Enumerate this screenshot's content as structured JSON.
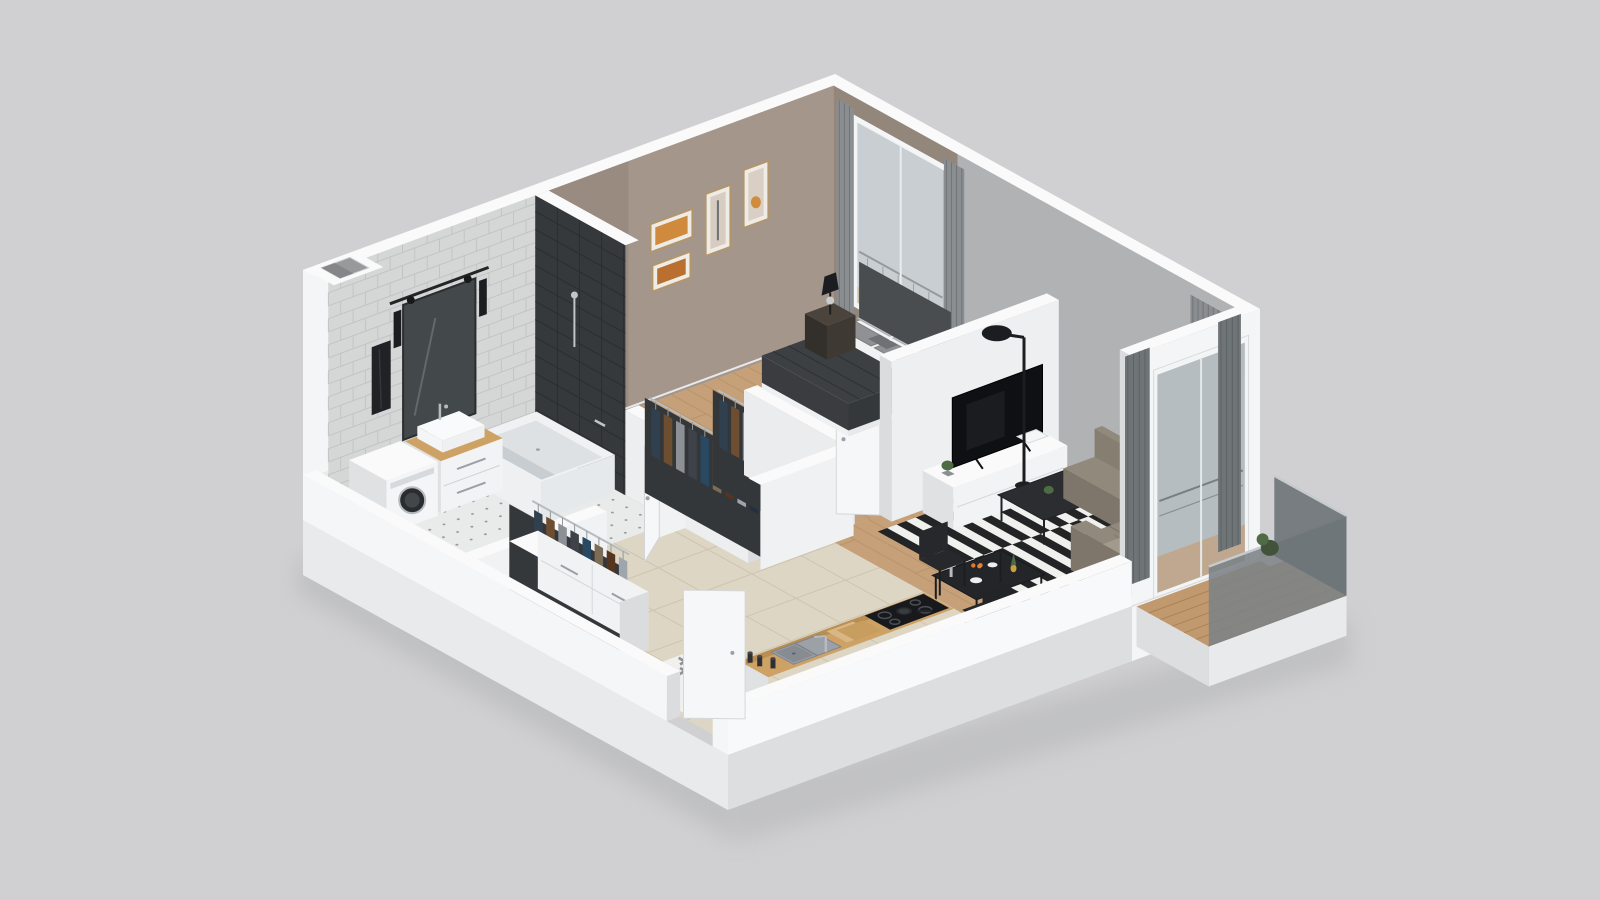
{
  "scene": {
    "title": "3D apartment floor plan",
    "style": "dollhouse isometric render",
    "background": "#d0d0d2"
  },
  "rooms": [
    {
      "id": "bathroom",
      "label": "Bathroom",
      "furniture": [
        "shower niche with sliding glass door",
        "vanity cabinet with washbasin",
        "washing machine",
        "bathtub",
        "black towel",
        "vent shaft"
      ]
    },
    {
      "id": "bedroom",
      "label": "Bedroom",
      "furniture": [
        "double bed with dark blanket",
        "two nightstands",
        "black table lamp",
        "potted plant",
        "four framed pictures",
        "window with gray curtains",
        "open wardrobe with hanging clothes"
      ]
    },
    {
      "id": "living-dining",
      "label": "Living / dining room",
      "furniture": [
        "TV on white media console",
        "black floor lamp",
        "black and white striped rug",
        "black coffee table",
        "beige corner sofa",
        "dining table with two chairs",
        "balcony door with gray curtains"
      ]
    },
    {
      "id": "kitchen",
      "label": "Kitchen",
      "furniture": [
        "wooden counter with sink",
        "black cooktop with pan",
        "cutting boards",
        "spice jars",
        "fridge position marker",
        "entry door"
      ]
    },
    {
      "id": "hallway",
      "label": "Hallway",
      "furniture": [
        "white wardrobe cabinets with clothes rail"
      ]
    },
    {
      "id": "balcony",
      "label": "Balcony",
      "furniture": [
        "glass balustrade",
        "wooden decking",
        "potted plant"
      ]
    }
  ],
  "icons": {
    "fridge": {
      "name": "snowflake-icon",
      "glyph": "❄"
    }
  },
  "palette": {
    "bg": "#d0d0d2",
    "wall_top": "#fafafa",
    "wall_outer_light": "#f4f5f6",
    "wall_outer_shade": "#dadcde",
    "slab_face": "#e9eaec",
    "slab_shade": "#dddee0",
    "wall_inner_gray": "#b0b2b4",
    "taupe_wall": "#a4968a",
    "taupe_wall_side": "#93867b",
    "tile_wall": "#d5d7d7",
    "tile_line": "#c2c4c4",
    "dark_wall": "#36393c",
    "wood_floor": "#c6a078",
    "wood_line": "#b08a5e",
    "tile_floor": "#ded6c4",
    "tile_floor_line": "#cdc5af",
    "bath_floor": "#e9eaea",
    "bath_dot": "#3c3e40",
    "rug_white": "#f0f0ef",
    "rug_black": "#222426",
    "sofa": "#91897b",
    "sofa_shade": "#7e766a",
    "sofa_back": "#867e71",
    "cushion_dark": "#303234",
    "table_black": "#232528",
    "chair_black": "#26282b",
    "wood_counter": "#cda264",
    "wood_counter_shade": "#b98e52",
    "sink_gray": "#9ba1a6",
    "cooktop": "#17191c",
    "tv_black": "#0e1013",
    "console_white": "#f2f3f5",
    "console_shade": "#dfe1e3",
    "lamp_black": "#1b1d20",
    "bed_white": "#f1f2f3",
    "bed_blanket": "#3d4043",
    "blanket_side": "#35383b",
    "pillow_gray": "#8f9194",
    "pillow_light": "#c2c4c6",
    "headboard": "#4a4d50",
    "nightstand_front": "#3e3933",
    "nightstand_top": "#4a443d",
    "nightstand_side": "#332f2a",
    "plant_green": "#4e6b45",
    "plant_dark": "#41543b",
    "curtain_gray": "#8a8e91",
    "curtain_dark": "#6f7477",
    "door_white": "#f6f7f8",
    "frame_wood": "#b2956a",
    "art_orange": "#d08a3e",
    "art_orange2": "#b96f2f",
    "art_beige": "#d6ccc0",
    "metal": "#b7bcc0",
    "snow_tile": "#f0f0ef",
    "snow_icon": "#8f9294",
    "glass_blue": "#a9b1b5",
    "balcony_glass": "#7c8286",
    "balcony_glass_end": "#6d7377",
    "washer_door": "#2a2d30"
  },
  "clothes_colors": [
    "#31404f",
    "#6e4e31",
    "#8d9196",
    "#3e434a",
    "#284961",
    "#7d6c55",
    "#55351f",
    "#9fa5ad",
    "#23303d",
    "#5d4a33"
  ]
}
